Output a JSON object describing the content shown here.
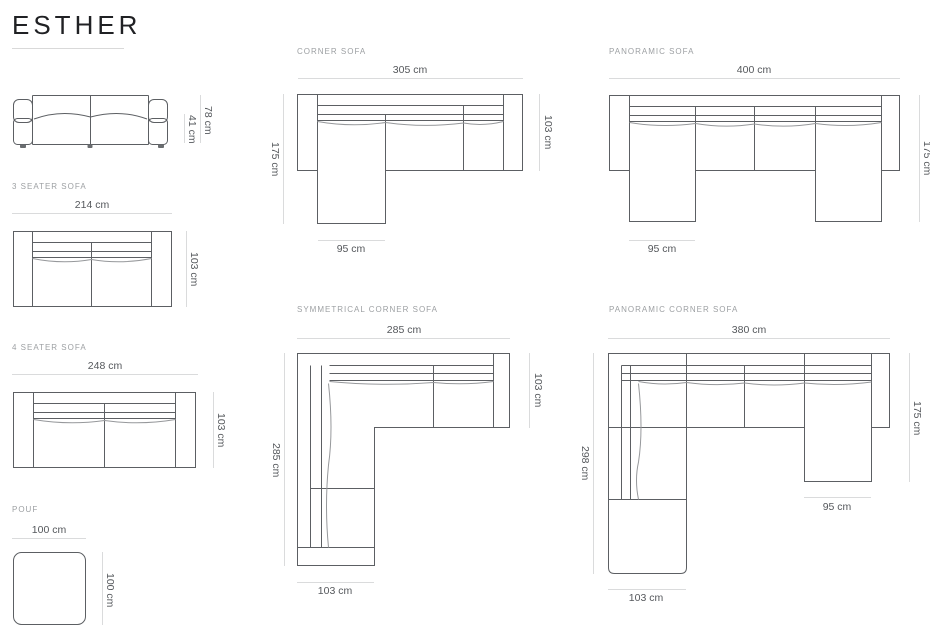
{
  "title": "ESTHER",
  "sections": {
    "front_view": {
      "dims": {
        "total_height": "78 cm",
        "seat_height": "41 cm"
      }
    },
    "seater3": {
      "label": "3 SEATER SOFA",
      "dims": {
        "width": "214 cm",
        "depth": "103 cm"
      }
    },
    "seater4": {
      "label": "4 SEATER SOFA",
      "dims": {
        "width": "248 cm",
        "depth": "103 cm"
      }
    },
    "pouf": {
      "label": "POUF",
      "dims": {
        "width": "100 cm",
        "depth": "100 cm"
      }
    },
    "corner": {
      "label": "CORNER SOFA",
      "dims": {
        "width": "305 cm",
        "depth_total": "175 cm",
        "depth": "103 cm",
        "chaise_width": "95 cm"
      }
    },
    "panoramic": {
      "label": "PANORAMIC SOFA",
      "dims": {
        "width": "400 cm",
        "depth_total": "175 cm",
        "chaise_width": "95 cm"
      }
    },
    "symmetrical": {
      "label": "SYMMETRICAL CORNER SOFA",
      "dims": {
        "width": "285 cm",
        "depth_total": "285 cm",
        "depth": "103 cm",
        "arm_width": "103 cm"
      }
    },
    "panoramic_corner": {
      "label": "PANORAMIC CORNER SOFA",
      "dims": {
        "width": "380 cm",
        "depth_total": "298 cm",
        "right_depth": "175 cm",
        "chaise_width": "95 cm",
        "arm_width": "103 cm"
      }
    }
  },
  "colors": {
    "outline": "#5c5f63",
    "cushion_line": "#96989b",
    "dimension_line": "#dadbdc",
    "dimension_text": "#55585c",
    "label_text": "#9da0a3",
    "title_text": "#202124",
    "background": "#ffffff"
  }
}
